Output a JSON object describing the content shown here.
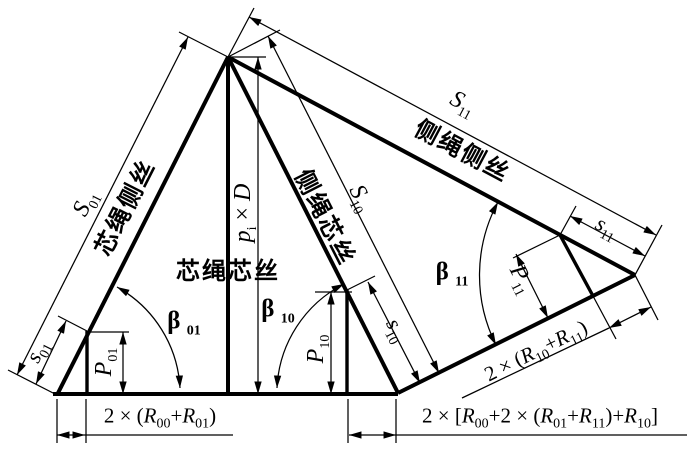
{
  "figure": {
    "type": "engineering-lay-development-diagram",
    "background_color": "#ffffff",
    "line_color": "#000000"
  },
  "labels": {
    "core_side_wire": "芯绳侧丝",
    "core_core_wire": "芯绳芯丝",
    "side_core_wire": "侧绳芯丝",
    "side_side_wire": "侧绳侧丝",
    "S01": {
      "base": "S",
      "sub": "01"
    },
    "S10": {
      "base": "S",
      "sub": "10"
    },
    "S11": {
      "base": "S",
      "sub": "11"
    },
    "s01": {
      "base": "s",
      "sub": "01"
    },
    "s10": {
      "base": "s",
      "sub": "10"
    },
    "s11": {
      "base": "s",
      "sub": "11"
    },
    "P01": {
      "base": "P",
      "sub": "01"
    },
    "P10": {
      "base": "P",
      "sub": "10"
    },
    "P11": {
      "base": "P",
      "sub": "11"
    },
    "beta01": {
      "base": "β",
      "sub": "01"
    },
    "beta10": {
      "base": "β",
      "sub": "10"
    },
    "beta11": {
      "base": "β",
      "sub": "11"
    },
    "pitch": {
      "base": "p",
      "sub": "i",
      "times": " × ",
      "d": "D"
    },
    "dim_r00_r01": {
      "p0": "2 × (",
      "r1": "R",
      "s1": "00",
      "p2": "+",
      "r2": "R",
      "s2": "01",
      "p3": ")"
    },
    "dim_r10_r11": {
      "p0": "2 × (",
      "r1": "R",
      "s1": "10",
      "p2": "+",
      "r2": "R",
      "s2": "11",
      "p3": ")"
    },
    "dim_total": {
      "p0": "2 × [",
      "r1": "R",
      "s1": "00",
      "p2": "+2 × (",
      "r2": "R",
      "s2": "01",
      "p3": "+",
      "r3": "R",
      "s3": "11",
      "p4": ")+",
      "r4": "R",
      "s4": "10",
      "p5": "]"
    }
  }
}
